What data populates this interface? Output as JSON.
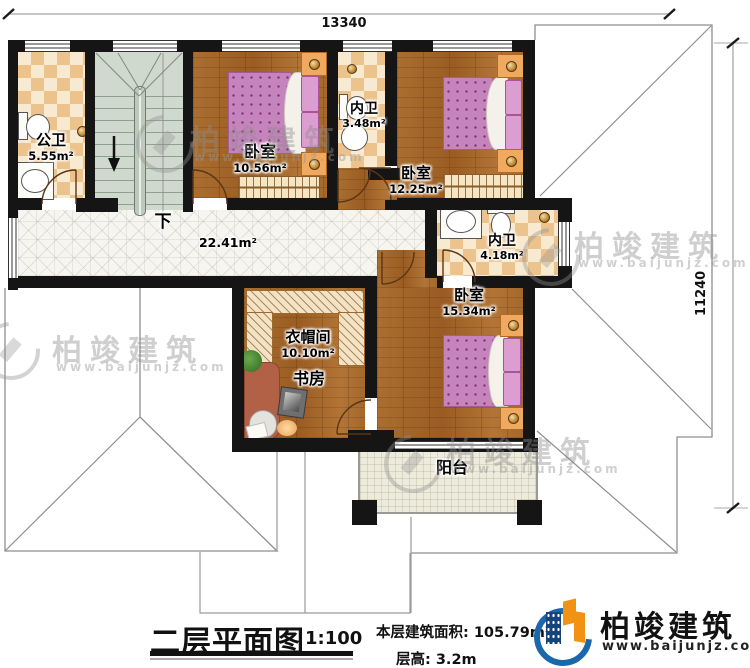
{
  "dimensions": {
    "top": "13340",
    "right": "11240"
  },
  "rooms": {
    "public_bath": {
      "name": "公卫",
      "area": "5.55m²"
    },
    "bedroom_small": {
      "name": "卧室",
      "area": "10.56m²"
    },
    "bath_inner_a": {
      "name": "内卫",
      "area": "3.48m²"
    },
    "bedroom_mid": {
      "name": "卧室",
      "area": "12.25m²"
    },
    "bath_inner_b": {
      "name": "内卫",
      "area": "4.18m²"
    },
    "bedroom_big": {
      "name": "卧室",
      "area": "15.34m²"
    },
    "cloakroom": {
      "name": "衣帽间",
      "area": "10.10m²"
    },
    "study": {
      "name": "书房"
    },
    "balcony": {
      "name": "阳台"
    },
    "hallway": {
      "area": "22.41m²"
    },
    "stairs": {
      "down": "下"
    }
  },
  "titleblock": {
    "title": "二层平面图",
    "scale": "1:100",
    "area_note": "本层建筑面积: 105.79m²",
    "height_note": "层高: 3.2m"
  },
  "logo": {
    "brand": "柏竣建筑",
    "site": "www.baijunjz.com"
  },
  "watermark": {
    "brand": "柏竣建筑",
    "site": "www.baijunjz.com"
  },
  "colors": {
    "wall": "#151515",
    "wood": "#a4682c",
    "bed": "#c684bc",
    "logo_blue": "#1b67ab",
    "logo_orange": "#f29213"
  }
}
